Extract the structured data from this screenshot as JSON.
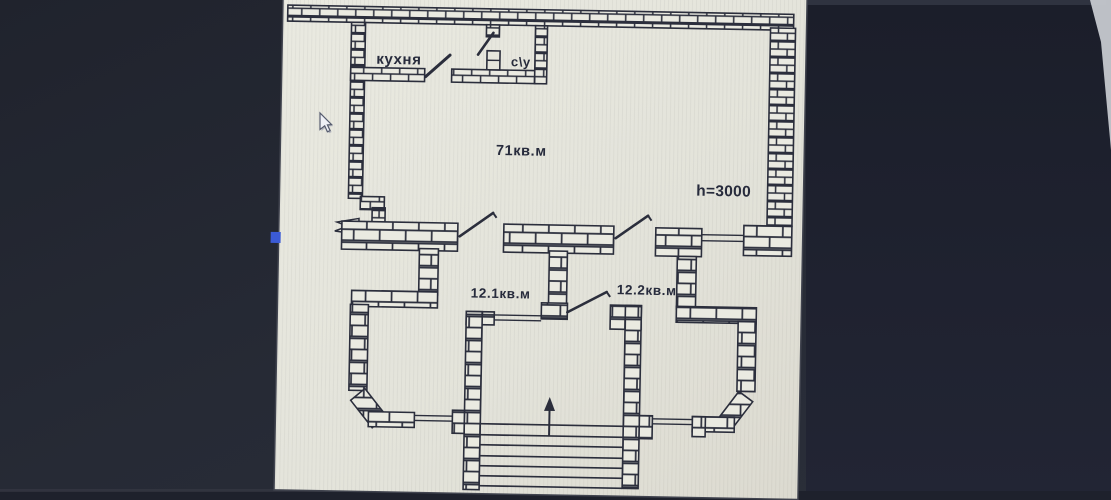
{
  "screen": {
    "background_color": "#262a35",
    "right_panel_color": "#1d2030",
    "bottom_band_color": "#1e212c",
    "corner_glare_color": "#c6c9cf"
  },
  "floorplan": {
    "paper_color": "#e5e5dc",
    "ink_color": "#2b2e3c",
    "labels": {
      "kitchen": "кухня",
      "bathroom": "с\\у",
      "main_area": "71кв.м",
      "ceiling_height": "h=3000",
      "room_small_1": "12.1кв.м",
      "room_small_2": "12.2кв.м"
    }
  },
  "cursor": {
    "type": "arrow-pointer",
    "color": "#eef0f6"
  },
  "marker": {
    "color": "#3b5bd6"
  }
}
